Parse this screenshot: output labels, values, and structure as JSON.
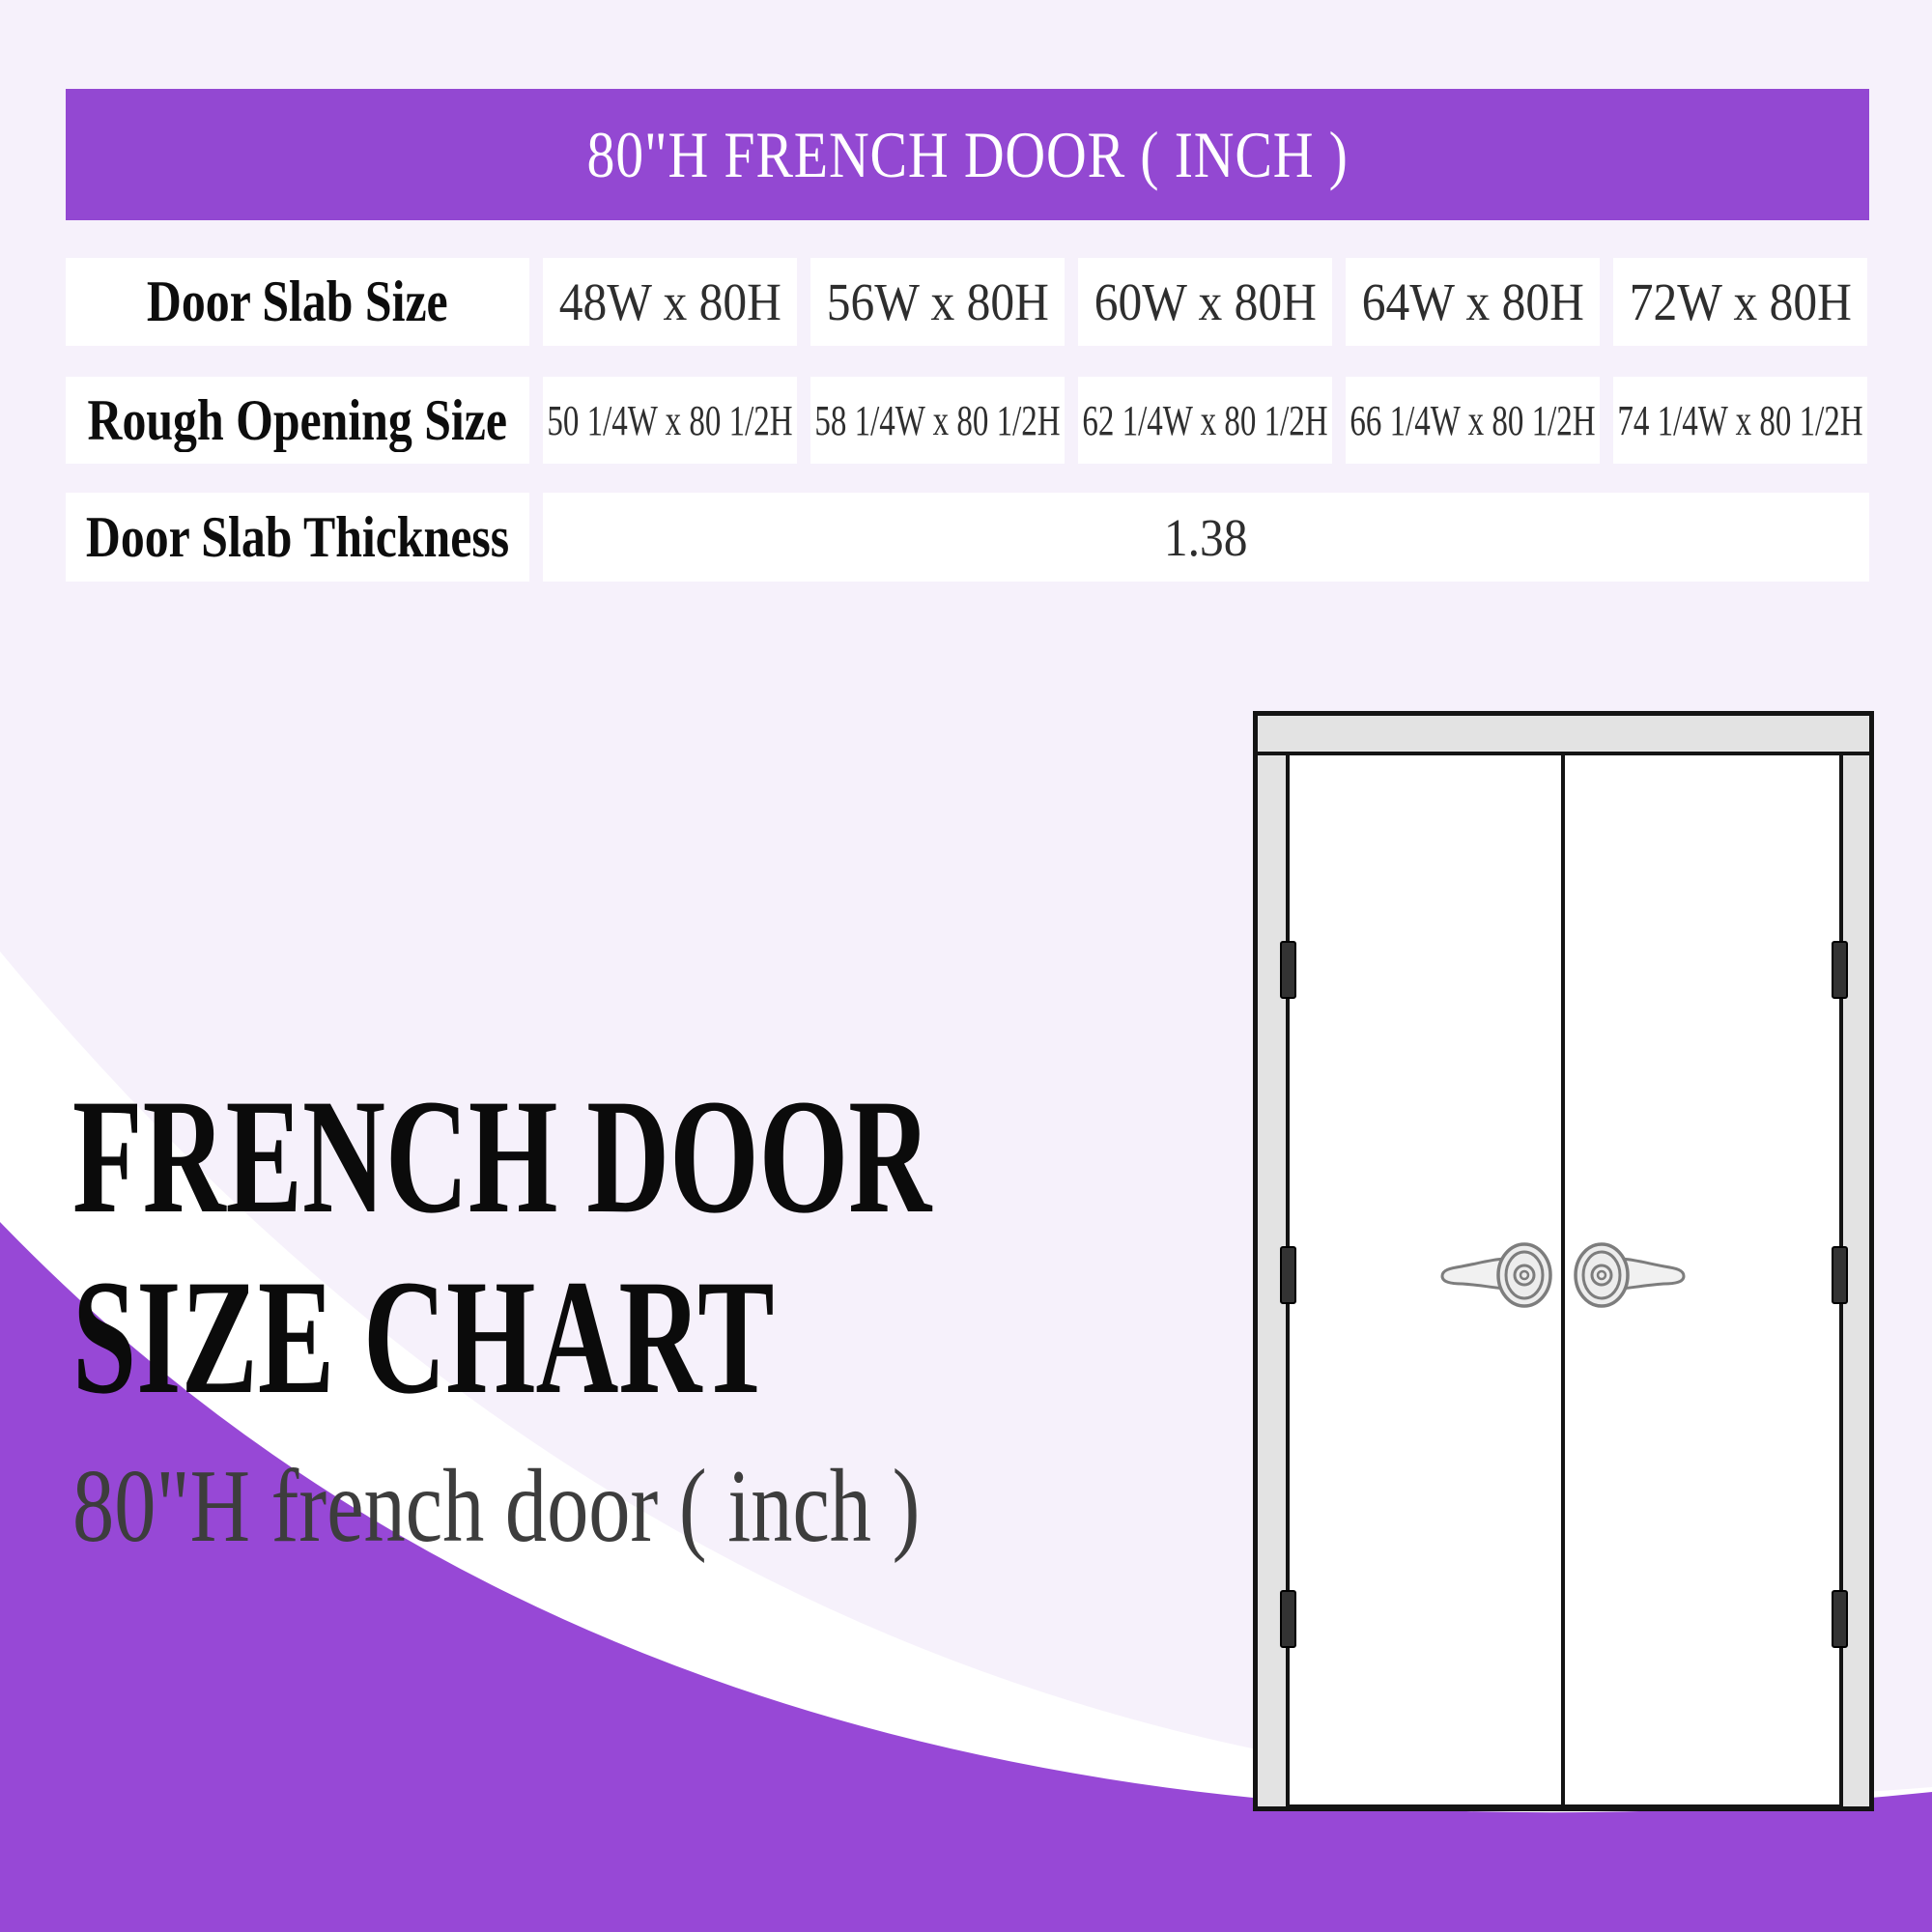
{
  "banner": {
    "title": "80\"H FRENCH DOOR ( INCH )"
  },
  "table": {
    "rows": [
      {
        "label": "Door Slab Size",
        "cells": [
          "48W x 80H",
          "56W x 80H",
          "60W x 80H",
          "64W x 80H",
          "72W x 80H"
        ]
      },
      {
        "label": "Rough Opening Size",
        "cells": [
          "50 1/4W x 80 1/2H",
          "58 1/4W x 80 1/2H",
          "62 1/4W x 80 1/2H",
          "66 1/4W x 80 1/2H",
          "74 1/4W x 80 1/2H"
        ]
      },
      {
        "label": "Door Slab Thickness",
        "merged_value": "1.38"
      }
    ]
  },
  "headline": {
    "line1": "FRENCH DOOR",
    "line2": "SIZE CHART"
  },
  "subtitle": "80\"H french door ( inch )",
  "icons": {
    "hinge_icon": "door-hinge",
    "door_handle_icon": "lever-door-handle"
  },
  "colors": {
    "banner_purple": "#9348d2",
    "swoosh_purple": "#9748d6",
    "background_lavender": "#f6f1fb",
    "white_band": "#ffffff",
    "cell_white": "#ffffff",
    "title_black": "#0b0b0b",
    "subtitle_gray": "#3d3d3d",
    "value_gray": "#2e2e2e",
    "door_frame_gray": "#e3e3e3",
    "door_line_black": "#141414"
  },
  "chart_data": {
    "type": "table",
    "title": "80\"H FRENCH DOOR ( INCH )",
    "row_headers": [
      "Door Slab Size",
      "Rough Opening Size",
      "Door Slab Thickness"
    ],
    "rows": [
      [
        "48W x 80H",
        "56W x 80H",
        "60W x 80H",
        "64W x 80H",
        "72W x 80H"
      ],
      [
        "50 1/4W x 80 1/2H",
        "58 1/4W x 80 1/2H",
        "62 1/4W x 80 1/2H",
        "66 1/4W x 80 1/2H",
        "74 1/4W x 80 1/2H"
      ],
      [
        "1.38"
      ]
    ],
    "notes": "Door Slab Thickness value 1.38 spans all five size columns"
  }
}
